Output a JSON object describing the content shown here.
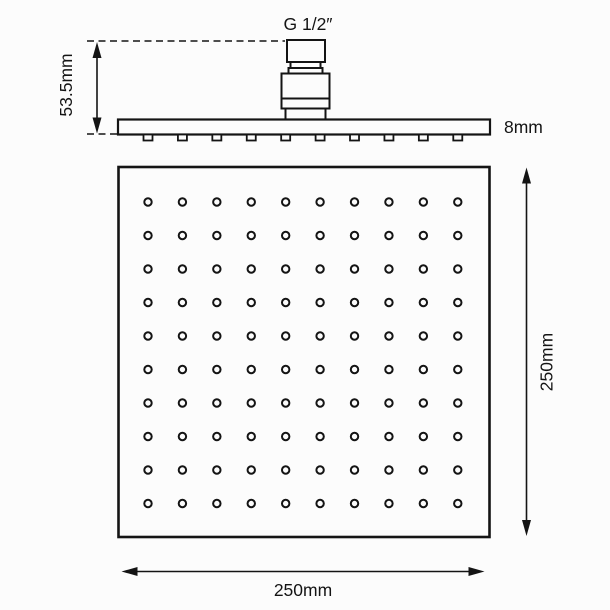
{
  "diagram": {
    "type": "technical-dimension-drawing",
    "side_view": {
      "connector_label": "G 1/2″",
      "height_label": "53.5mm",
      "thickness_label": "8mm",
      "nozzle_count": 10
    },
    "bottom_view": {
      "width_label": "250mm",
      "height_label": "250mm",
      "hole_grid": {
        "rows": 10,
        "cols": 10
      }
    },
    "colors": {
      "line": "#141414",
      "background": "#fcfcfc"
    }
  }
}
